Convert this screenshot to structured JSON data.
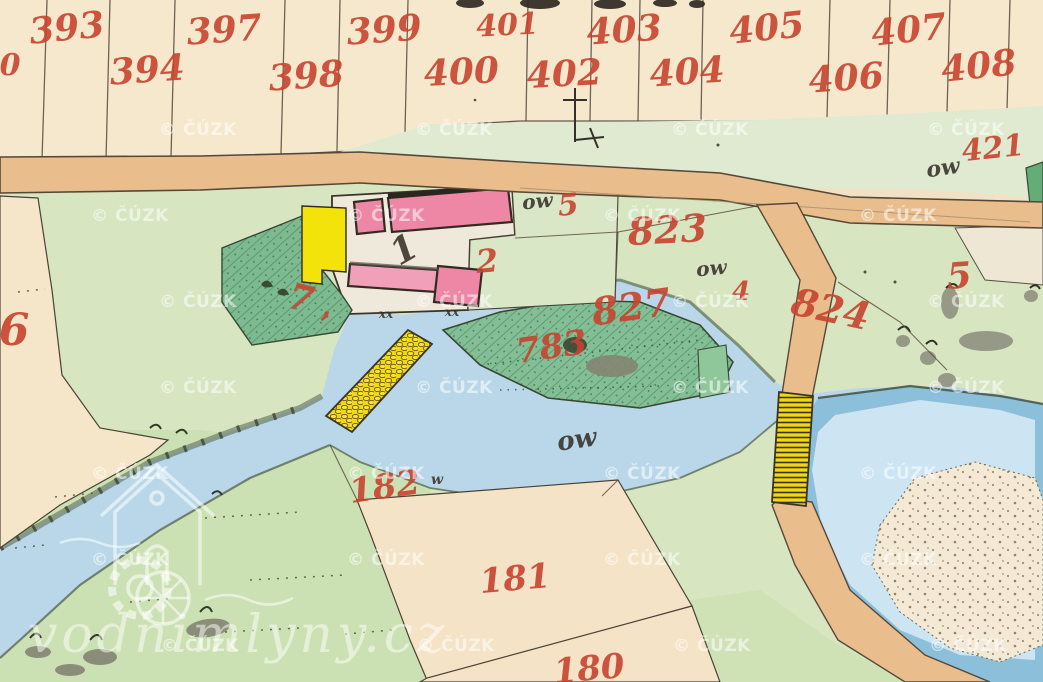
{
  "map": {
    "source_watermark": {
      "text": "© ČÚZK",
      "color": "rgba(255,255,255,0.55)",
      "positions": [
        {
          "x": 158,
          "y": 127
        },
        {
          "x": 414,
          "y": 127
        },
        {
          "x": 670,
          "y": 127
        },
        {
          "x": 926,
          "y": 127
        },
        {
          "x": 90,
          "y": 213
        },
        {
          "x": 346,
          "y": 213
        },
        {
          "x": 602,
          "y": 213
        },
        {
          "x": 858,
          "y": 213
        },
        {
          "x": 158,
          "y": 299
        },
        {
          "x": 414,
          "y": 299
        },
        {
          "x": 670,
          "y": 299
        },
        {
          "x": 926,
          "y": 299
        },
        {
          "x": 158,
          "y": 385
        },
        {
          "x": 414,
          "y": 385
        },
        {
          "x": 670,
          "y": 385
        },
        {
          "x": 926,
          "y": 385
        },
        {
          "x": 90,
          "y": 471
        },
        {
          "x": 346,
          "y": 471
        },
        {
          "x": 602,
          "y": 471
        },
        {
          "x": 858,
          "y": 471
        },
        {
          "x": 90,
          "y": 557
        },
        {
          "x": 346,
          "y": 557
        },
        {
          "x": 602,
          "y": 557
        },
        {
          "x": 858,
          "y": 557
        },
        {
          "x": 160,
          "y": 643
        },
        {
          "x": 416,
          "y": 643
        },
        {
          "x": 672,
          "y": 643
        },
        {
          "x": 928,
          "y": 643
        }
      ]
    },
    "logo_watermark": {
      "text": "vodnimlyny.cz"
    },
    "palette": {
      "paper_cream": "#f1e2c6",
      "field_cream": "#f6e8cd",
      "road_tan": "#e9bd8c",
      "meadow_green": "#d7e5c1",
      "garden_green": "#7cba90",
      "island_green": "#82bf95",
      "water_blue": "#b9d7e8",
      "pond_rim_blue": "#8cc0da",
      "building_pink": "#ee86a5",
      "building_yellow": "#f4e20b",
      "ink_red": "#c8432f",
      "ink_black": "#36302a"
    },
    "parcel_numbers_red": [
      {
        "text": "393",
        "x": 68,
        "y": 40,
        "size": 36,
        "rot": -6
      },
      {
        "text": "397",
        "x": 225,
        "y": 42,
        "size": 36,
        "rot": -4
      },
      {
        "text": "399",
        "x": 385,
        "y": 42,
        "size": 36,
        "rot": -4
      },
      {
        "text": "401",
        "x": 508,
        "y": 35,
        "size": 30,
        "rot": -3
      },
      {
        "text": "403",
        "x": 625,
        "y": 42,
        "size": 36,
        "rot": -4
      },
      {
        "text": "405",
        "x": 768,
        "y": 40,
        "size": 36,
        "rot": -6
      },
      {
        "text": "407",
        "x": 910,
        "y": 42,
        "size": 36,
        "rot": -6
      },
      {
        "text": "0",
        "x": 10,
        "y": 75,
        "size": 30,
        "rot": 0
      },
      {
        "text": "394",
        "x": 148,
        "y": 82,
        "size": 36,
        "rot": -4
      },
      {
        "text": "398",
        "x": 307,
        "y": 88,
        "size": 36,
        "rot": -4
      },
      {
        "text": "400",
        "x": 462,
        "y": 84,
        "size": 36,
        "rot": -3
      },
      {
        "text": "402",
        "x": 565,
        "y": 86,
        "size": 36,
        "rot": -3
      },
      {
        "text": "404",
        "x": 688,
        "y": 84,
        "size": 36,
        "rot": -4
      },
      {
        "text": "406",
        "x": 847,
        "y": 90,
        "size": 36,
        "rot": -4
      },
      {
        "text": "408",
        "x": 980,
        "y": 78,
        "size": 36,
        "rot": -6
      },
      {
        "text": "421",
        "x": 994,
        "y": 158,
        "size": 30,
        "rot": -6
      },
      {
        "text": "823",
        "x": 668,
        "y": 243,
        "size": 38,
        "rot": -3
      },
      {
        "text": "827",
        "x": 633,
        "y": 320,
        "size": 38,
        "rot": -8
      },
      {
        "text": "824",
        "x": 828,
        "y": 322,
        "size": 38,
        "rot": 12
      },
      {
        "text": "783",
        "x": 553,
        "y": 358,
        "size": 34,
        "rot": -8
      },
      {
        "text": "182",
        "x": 386,
        "y": 498,
        "size": 34,
        "rot": -8
      },
      {
        "text": "181",
        "x": 516,
        "y": 590,
        "size": 34,
        "rot": -5
      },
      {
        "text": "180",
        "x": 590,
        "y": 680,
        "size": 34,
        "rot": -5
      },
      {
        "text": "6",
        "x": 14,
        "y": 345,
        "size": 44,
        "rot": 0
      },
      {
        "text": "5",
        "x": 569,
        "y": 215,
        "size": 30,
        "rot": -5
      },
      {
        "text": "5",
        "x": 960,
        "y": 288,
        "size": 36,
        "rot": -4
      },
      {
        "text": "2",
        "x": 488,
        "y": 272,
        "size": 32,
        "rot": -5
      },
      {
        "text": "7",
        "x": 298,
        "y": 310,
        "size": 36,
        "rot": 14
      },
      {
        "text": ",",
        "x": 326,
        "y": 316,
        "size": 30,
        "rot": 0
      },
      {
        "text": "4",
        "x": 741,
        "y": 300,
        "size": 26,
        "rot": 0
      }
    ],
    "annotations_black": [
      {
        "text": "ow",
        "x": 538,
        "y": 208,
        "size": 20,
        "rot": -5
      },
      {
        "text": "ow",
        "x": 712,
        "y": 275,
        "size": 20,
        "rot": -5
      },
      {
        "text": "ow",
        "x": 944,
        "y": 175,
        "size": 22,
        "rot": -8
      },
      {
        "text": "ow",
        "x": 578,
        "y": 448,
        "size": 26,
        "rot": -8
      },
      {
        "text": "w",
        "x": 437,
        "y": 484,
        "size": 14,
        "rot": 0
      },
      {
        "text": "1",
        "x": 410,
        "y": 260,
        "size": 36,
        "rot": -30
      },
      {
        "text": "xx",
        "x": 386,
        "y": 318,
        "size": 12,
        "rot": 0
      },
      {
        "text": "xx",
        "x": 452,
        "y": 316,
        "size": 12,
        "rot": 0
      }
    ]
  }
}
